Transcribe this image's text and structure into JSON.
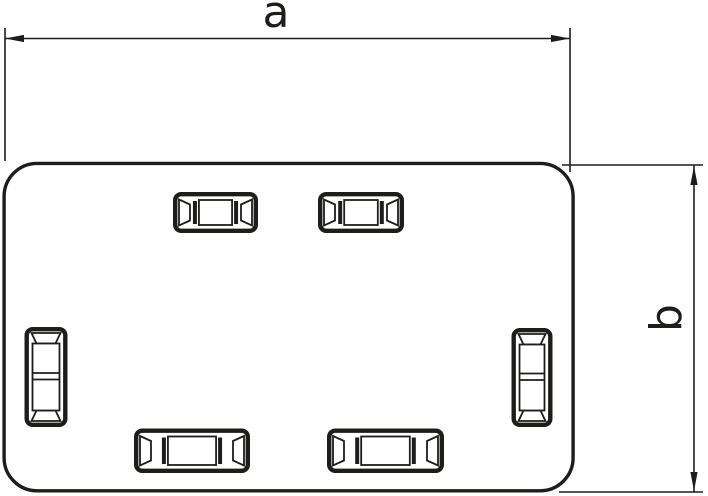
{
  "figure": {
    "type": "technical-drawing",
    "background": "#ffffff",
    "line_color": "#1d1d1b",
    "dimensions": [
      {
        "id": "a",
        "label": "a",
        "axis": "horizontal"
      },
      {
        "id": "b",
        "label": "b",
        "axis": "vertical"
      }
    ],
    "part": {
      "shape": "rounded-rectangle-end-piece",
      "knockout_slots": {
        "top": 2,
        "bottom": 2,
        "left": 1,
        "right": 1
      }
    },
    "slots": [
      {
        "orientation": "h",
        "x": 173,
        "y": 192,
        "w": 85,
        "h": 41
      },
      {
        "orientation": "h",
        "x": 318,
        "y": 192,
        "w": 86,
        "h": 41
      },
      {
        "orientation": "h",
        "x": 134,
        "y": 428.5,
        "w": 116,
        "h": 44.5
      },
      {
        "orientation": "h",
        "x": 327,
        "y": 428.5,
        "w": 117,
        "h": 44.5
      },
      {
        "orientation": "v",
        "x": 24.5,
        "y": 327,
        "w": 43,
        "h": 100
      },
      {
        "orientation": "v",
        "x": 511.5,
        "y": 328,
        "w": 41,
        "h": 99
      }
    ]
  }
}
